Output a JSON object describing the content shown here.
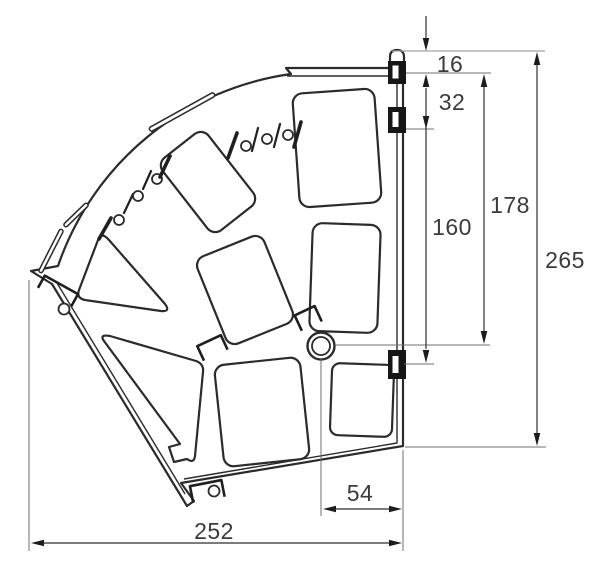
{
  "drawing": {
    "kind": "technical dimension drawing",
    "subject": "fan-shaped hinged panel (plan view)",
    "colors": {
      "outline": "#2b2b2b",
      "hinge_fill": "#161616",
      "dimension_lines": "#2f2f2f",
      "extension_lines": "#6f6f6f",
      "label_text": "#3b3b3b",
      "background": "#ffffff"
    }
  },
  "dims": {
    "d16": "16",
    "d32": "32",
    "d160": "160",
    "d178": "178",
    "d265": "265",
    "d54": "54",
    "d252": "252"
  }
}
